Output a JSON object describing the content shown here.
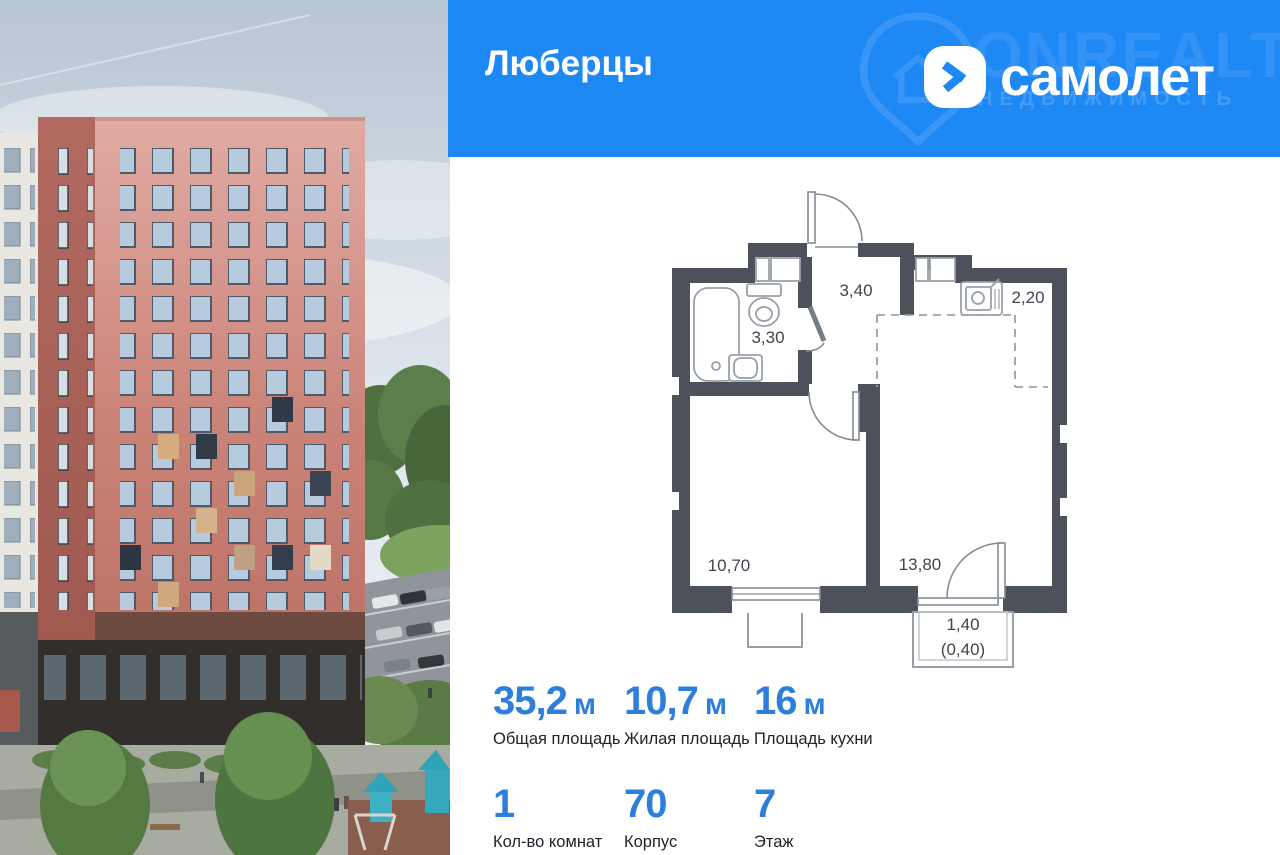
{
  "banner": {
    "title": "Люберцы",
    "brand": "самолет",
    "watermark_line1": "ONREALT",
    "watermark_line2": "НЕДВИЖИМОСТЬ",
    "bg_color": "#1e88f5"
  },
  "floor_plan": {
    "wall_color": "#4c515a",
    "rooms": [
      {
        "name": "hallway",
        "area": "3,40"
      },
      {
        "name": "bathroom",
        "area": "3,30"
      },
      {
        "name": "kitchen-niche",
        "area": "2,20"
      },
      {
        "name": "living-room",
        "area": "10,70"
      },
      {
        "name": "kitchen-living-room",
        "area": "13,80"
      },
      {
        "name": "balcony",
        "area": "1,40",
        "area_secondary": "(0,40)"
      }
    ]
  },
  "stats": {
    "accent_color": "#2d7fdb",
    "row1": [
      {
        "value": "35,2",
        "unit": "м",
        "label": "Общая площадь"
      },
      {
        "value": "10,7",
        "unit": "м",
        "label": "Жилая площадь"
      },
      {
        "value": "16",
        "unit": "м",
        "label": "Площадь кухни"
      }
    ],
    "row2": [
      {
        "value": "1",
        "label": "Кол-во комнат"
      },
      {
        "value": "70",
        "label": "Корпус"
      },
      {
        "value": "7",
        "label": "Этаж"
      }
    ]
  }
}
